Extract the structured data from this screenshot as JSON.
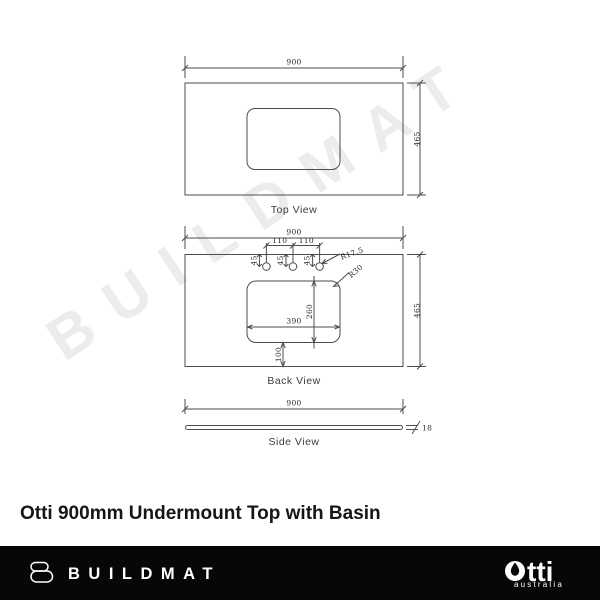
{
  "watermark": {
    "text": "BUILDMAT"
  },
  "title": "Otti 900mm Undermount Top with Basin",
  "views": {
    "top": {
      "label": "Top View",
      "dim_width": "900",
      "dim_depth": "465"
    },
    "back": {
      "label": "Back View",
      "dim_width": "900",
      "dim_depth": "465",
      "dim_tap_gap_left": "110",
      "dim_tap_gap_right": "110",
      "dim_tap_offset_1": "45",
      "dim_tap_offset_2": "45",
      "dim_tap_offset_3": "45",
      "dim_tap_radius": "R17.5",
      "dim_corner_radius": "R30",
      "dim_cutout_width": "390",
      "dim_cutout_height": "260",
      "dim_cutout_bottom": "100"
    },
    "side": {
      "label": "Side View",
      "dim_width": "900",
      "dim_thickness": "18"
    }
  },
  "footer": {
    "brand": "BUILDMAT",
    "otti": {
      "name": "otti",
      "wordmark_tail": "tti",
      "tagline": "australia"
    }
  },
  "colors": {
    "line": "#4d4d4d",
    "dim_text": "#2b2b2b",
    "watermark": "#ececec",
    "footer_bg": "#070707",
    "logo": "#ffffff"
  }
}
